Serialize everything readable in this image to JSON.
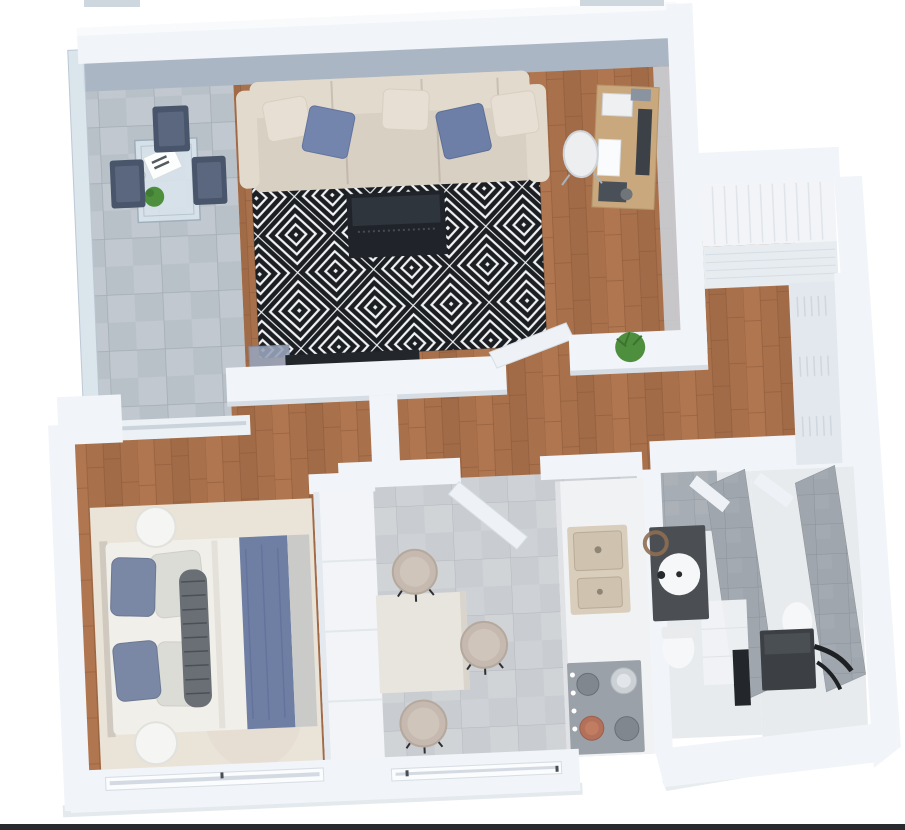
{
  "image_type": "3d-floor-plan-render",
  "view": "top-down isometric apartment plan, slightly rotated",
  "background": "#ffffff",
  "palette": {
    "wall": "#f1f4f8",
    "wallTopLight": "#f8fafc",
    "wallFace": "#aab6c4",
    "wallShade": "#ccd5de",
    "wallEdge": "#d6dde5",
    "cutCap": "#cfd7de",
    "groundShadow": "#c9d4dc",
    "frameLine": "#17181b",
    "wood": "#a9714b",
    "woodLight": "#b57a52",
    "woodDark": "#996644",
    "woodLine": "#875537",
    "balconyTile": "#b9c1c8",
    "balconyTileAlt": "#c6cdd3",
    "balconyTileLine": "#a4acb4",
    "glass": "#d9e4ec",
    "glassFrame": "#9cadb9",
    "chairNavy": "#49556a",
    "chairNavyIn": "#5b677e",
    "kitchenTile": "#c9ccd1",
    "kitchenTileAlt": "#d4d7db",
    "kitchenTileLine": "#b5b9bf",
    "rugWhite": "#f2f3f4",
    "rugBlack": "#1b1e22",
    "sofa": "#d9d0c4",
    "sofaBack": "#e2dacd",
    "sofaLine": "#c3b9ab",
    "pillowBeige": "#e7dfd3",
    "cushionBlue": "#7385ad",
    "cushionBlue2": "#6d7fa6",
    "tv": "#23262b",
    "console": "#20242a",
    "consoleTop": "#2f353d",
    "sideboardBlue": "#98a3ba",
    "deskWood": "#c9a87e",
    "monitor": "#3c4147",
    "chairWhite": "#eceef0",
    "plant": "#4e8f3e",
    "plantDark": "#3c7330",
    "bedRug": "#eae3d8",
    "bedMattress": "#f1efe9",
    "pillowBlue": "#7b88a5",
    "pillowLight": "#dcdcd7",
    "bolster": "#6a6f76",
    "bolsterLine": "#4b5056",
    "runnerBlue": "#6f7fa4",
    "runnerCrease": "#60719a",
    "blanketGray": "#cacbc9",
    "stoolWhite": "#f5f5f3",
    "tableWhite": "#e8e5df",
    "stoolBeige": "#c6bab0",
    "stoolBeigeIn": "#d0c5bb",
    "counter": "#f1f2f4",
    "sinkBeige": "#d9cdbb",
    "basin": "#cfc2ae",
    "stove": "#9ba1a8",
    "burner": "#81878e",
    "pot": "#ccd1d6",
    "copper": "#b3705a",
    "bathFloor": "#e8ebee",
    "bathTile": "#9fa6ad",
    "bathTileLine": "#8b929a",
    "vanity": "#4b4e52",
    "fixtureWhite": "#f6f7f8",
    "bronze": "#8d6e51",
    "darkUnit": "#3c4044",
    "black": "#1e2124",
    "closet": "#f2f4f7",
    "closetLine": "#dfe5eb",
    "closetFace": "#e7ecf1",
    "wardrobe": "#e3e8ee",
    "wardrobeLine": "#cfd6de",
    "windowGlass": "#c3ccd6",
    "doorPanel": "#eef2f6",
    "doorEdge": "#d6dee6"
  },
  "rooms": [
    {
      "name": "balcony",
      "floor": "large light-gray tiles",
      "items": [
        "glass table",
        "magazine",
        "small plant",
        "three dark-blue chairs",
        "glass balustrade"
      ]
    },
    {
      "name": "living-room",
      "floor": "wood planks",
      "items": [
        "beige sofa with blue cushions",
        "black-white geometric rug",
        "dark media console",
        "wall tv",
        "wood desk with monitor",
        "white desk chair",
        "blue sideboard",
        "green plant"
      ]
    },
    {
      "name": "hallway",
      "floor": "wood planks",
      "items": [
        "built-in closet nook",
        "slatted wardrobe"
      ]
    },
    {
      "name": "bedroom",
      "floor": "wood planks",
      "items": [
        "double bed",
        "blue runner",
        "blue and gray pillows",
        "striped bolster",
        "beige rug",
        "two round white stools",
        "tall white wardrobe",
        "window"
      ]
    },
    {
      "name": "kitchen",
      "floor": "gray tiles",
      "items": [
        "square dining table",
        "three beige stools",
        "counter with double sink",
        "cooktop with steel pot and copper pan",
        "window",
        "open door"
      ]
    },
    {
      "name": "bathrooms",
      "floor": "light tiles",
      "items": [
        "dark vanity with round sink",
        "bronze mirror",
        "two toilets",
        "tiled partition walls",
        "dark utility unit with hose",
        "open doors"
      ]
    }
  ]
}
